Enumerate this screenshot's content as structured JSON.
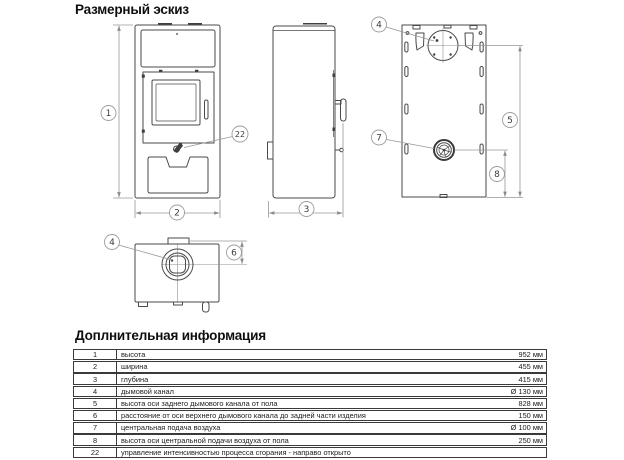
{
  "sections": {
    "sketch_title": "Размерный эскиз",
    "info_title": "Доплнительная информация"
  },
  "colors": {
    "background": "#ffffff",
    "outline": "#4a4a4a",
    "dimension_line": "#979797",
    "text": "#1c1c1c"
  },
  "diagram": {
    "callouts": {
      "height": "1",
      "width": "2",
      "depth": "3",
      "flue": "4",
      "rear_flue_height": "5",
      "flue_offset": "6",
      "central_air": "7",
      "air_height": "8",
      "combustion": "22"
    }
  },
  "table": {
    "rows": [
      {
        "num": "1",
        "desc": "высота",
        "value": "952 мм"
      },
      {
        "num": "2",
        "desc": "ширина",
        "value": "455 мм"
      },
      {
        "num": "3",
        "desc": "глубина",
        "value": "415 мм"
      },
      {
        "num": "4",
        "desc": "дымовой канал",
        "value": "Ø 130 мм"
      },
      {
        "num": "5",
        "desc": "высота оси заднего дымового канала от пола",
        "value": "828 мм"
      },
      {
        "num": "6",
        "desc": "расстояние от оси верхнего дымового канала до задней части изделия",
        "value": "150 мм"
      },
      {
        "num": "7",
        "desc": "центральная подача воздуха",
        "value": "Ø 100 мм"
      },
      {
        "num": "8",
        "desc": "высота оси центральной подачи воздуха от пола",
        "value": "250 мм"
      },
      {
        "num": "22",
        "desc": "управление интенсивностью процесса сгорания - направо открыто",
        "value": ""
      }
    ]
  }
}
